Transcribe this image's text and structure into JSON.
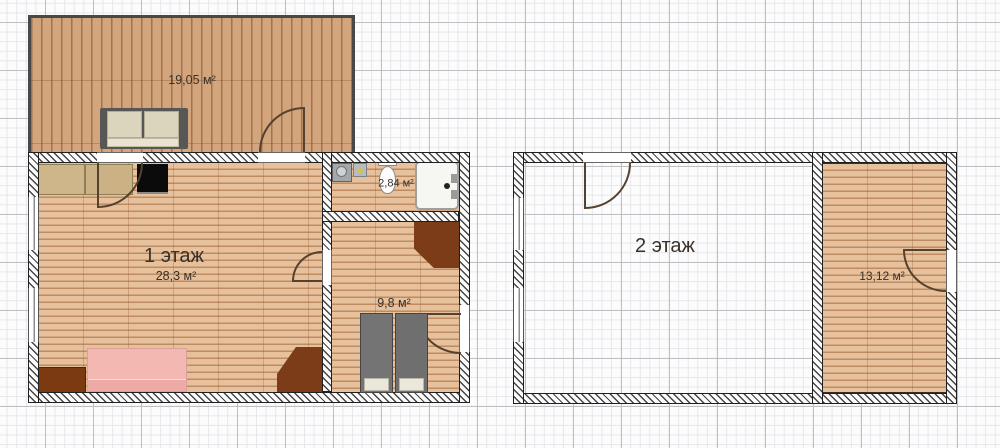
{
  "meta": {
    "app_type": "floor-plan-editor-canvas",
    "grid": {
      "minor_step_px": 9.6,
      "major_step_px": 48,
      "minor_color": "#e7e7ec",
      "major_color": "#bfbfc6"
    }
  },
  "colors": {
    "terrace_floor": "#d2a57c",
    "room_floor": "#e7c19b",
    "plank_line": "#96582e",
    "wall_hatch_line": "#454545",
    "wall_outline": "#1f1f1f",
    "wardrobe_brown": "#7d3c18",
    "dresser_brown": "#7b3a10",
    "bed_pink": "#f4b8b2",
    "bed_gray": "#747474",
    "counter_beige": "#cfb68a",
    "stove_black": "#0b0b0b",
    "door_line": "#55412f",
    "shower_white": "#f6f6f3"
  },
  "floor1": {
    "terrace": {
      "area_label": "19,05 м²"
    },
    "living": {
      "name_label": "1 этаж",
      "area_label": "28,3 м²"
    },
    "bathroom": {
      "area_label": "2,84 м²"
    },
    "bedroom": {
      "area_label": "9,8 м²"
    }
  },
  "floor2": {
    "hall": {
      "name_label": "2 этаж"
    },
    "room": {
      "area_label": "13,12 м²"
    }
  }
}
